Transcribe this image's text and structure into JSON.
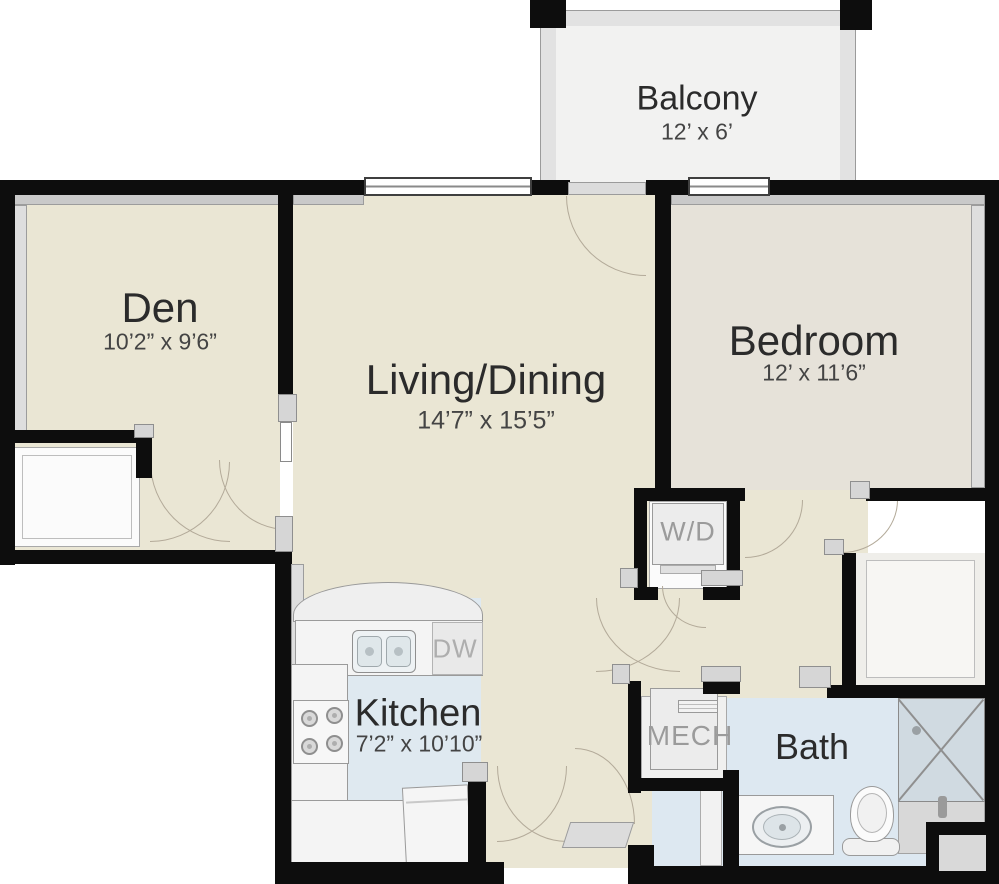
{
  "palette": {
    "wall": "#0d0d0d",
    "floor_main_beige": "#eae6d4",
    "floor_bedroom": "#e6e2d9",
    "floor_wet_blue": "#dde8f1",
    "floor_balcony": "#f1f1f0",
    "bevel_gray": "#c9c9c9",
    "fixture_white": "#f4f4f4",
    "label_text": "#2b2b2b",
    "muted_label": "#9b9b9b",
    "door_arc": "#b3aa99"
  },
  "rooms": {
    "balcony": {
      "name": "Balcony",
      "dims": "12’ x 6’"
    },
    "den": {
      "name": "Den",
      "dims": "10’2” x 9’6”"
    },
    "living": {
      "name": "Living/Dining",
      "dims": "14’7” x 15’5”"
    },
    "bedroom": {
      "name": "Bedroom",
      "dims": "12’ x 11’6”"
    },
    "kitchen": {
      "name": "Kitchen",
      "dims": "7’2” x 10’10”"
    },
    "bath": {
      "name": "Bath"
    }
  },
  "fixtures": {
    "washer_dryer": "W/D",
    "mechanical": "MECH",
    "dishwasher": "DW"
  }
}
